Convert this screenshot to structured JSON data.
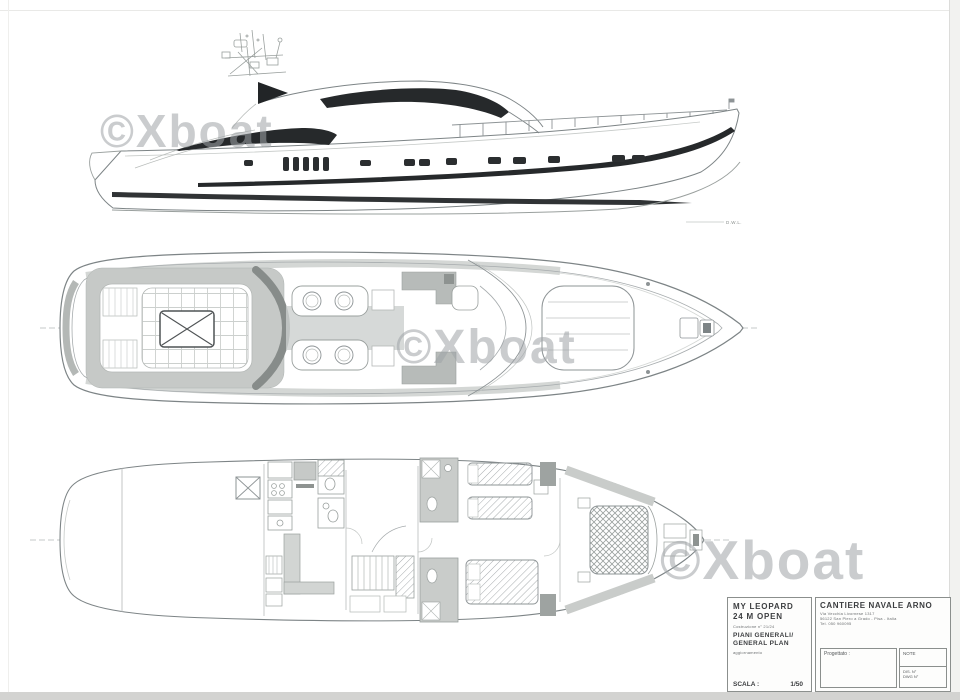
{
  "sheet": {
    "watermark": {
      "text": "©Xboat",
      "color": "#9fa4a7"
    },
    "labels": {
      "waterline": "D.W.L."
    },
    "colors": {
      "paper": "#ffffff",
      "line_dark": "#26292b",
      "line_mid": "#7d8486",
      "line_light": "#a7acae",
      "deck_shade": "#c6c9c7",
      "edge_strip": "#d3d3d1"
    },
    "title_block": {
      "boat_name": "MY LEOPARD",
      "boat_model": "24 M OPEN",
      "construction_no": "Costruzione n° 21/24",
      "drawing_title_primary": "PIANI GENERALI/",
      "drawing_title_secondary": "GENERAL PLAN",
      "revision_note": "aggiornamento",
      "scale_label": "SCALA :",
      "scale_value": "1/50",
      "shipyard_name": "CANTIERE NAVALE ARNO",
      "shipyard_address_1": "Via Vecchia Livornese 1317",
      "shipyard_address_2": "56122 San Piero a Grado - Pisa - Italia",
      "shipyard_address_3": "Tel. 050 960095",
      "designed_label": "Progettato :",
      "note_label": "NOTE",
      "drawing_no_label_1": "DIS. N°",
      "drawing_no_label_2": "DWG N°"
    }
  }
}
